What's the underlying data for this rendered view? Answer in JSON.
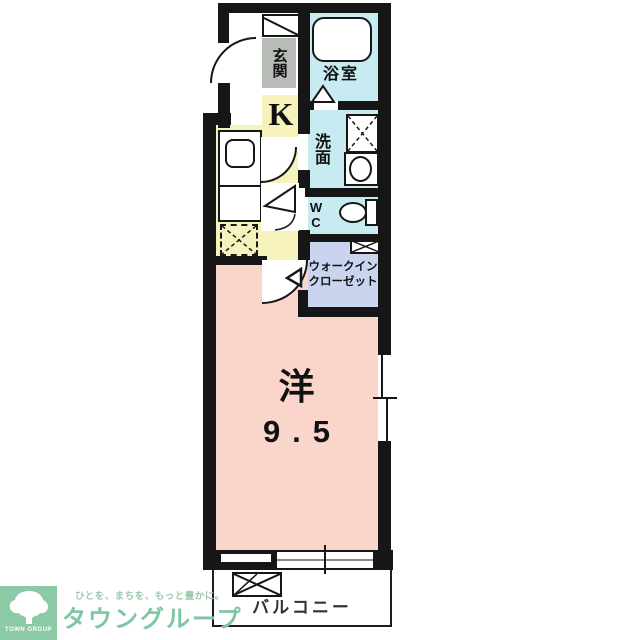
{
  "floorplan": {
    "rooms": {
      "genkan": {
        "label": "玄関"
      },
      "bathroom": {
        "label": "浴室"
      },
      "kitchen": {
        "label": "K"
      },
      "washroom": {
        "label": "洗面"
      },
      "wc": {
        "label": "WC"
      },
      "closet": {
        "label_line1": "ウォークイン",
        "label_line2": "クローゼット"
      },
      "main": {
        "label": "洋",
        "size": "9.5"
      },
      "balcony": {
        "label": "バルコニー"
      }
    },
    "colors": {
      "wall": "#161616",
      "genkan_gray": "#b7bcb7",
      "wet_cyan": "#c8ebf2",
      "kitchen_yellow": "#f6f2bb",
      "closet_lavender": "#cad4ee",
      "room_pink": "#f9d5cc"
    }
  },
  "logo": {
    "square_text": "TOWN GROUP",
    "tagline": "ひとを、まちを、もっと豊かに。",
    "name": "タウングループ",
    "brand_green": "#8cc9a5"
  }
}
